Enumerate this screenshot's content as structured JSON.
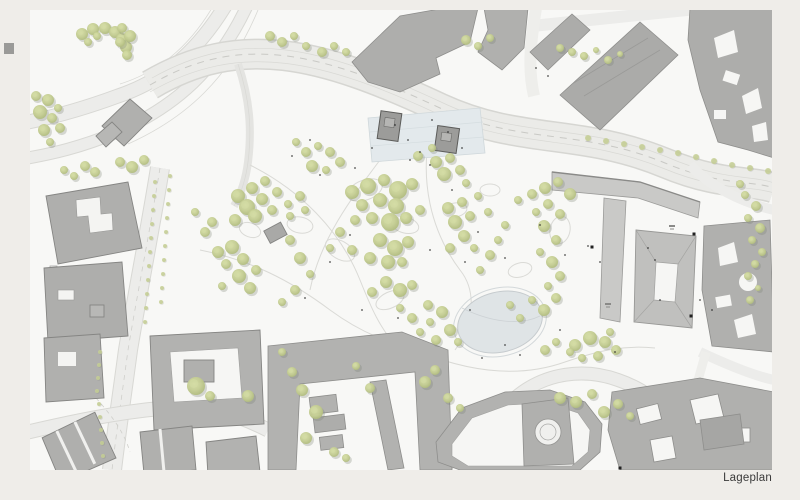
{
  "page": {
    "label": "Lageplan",
    "background": "#efede9",
    "sheet_color": "#f8f8f6"
  },
  "palette": {
    "road_fill": "#ebebe8",
    "road_edge": "#d6d6d2",
    "street_light": "#eeeeeb",
    "path_line": "#d9d9d5",
    "building": "#b2b2b0",
    "building_dark": "#a6a6a4",
    "building_light": "#c9c9c7",
    "building_court": "#c0c0be",
    "outline": "#8a8a87",
    "outline_soft": "#9b9b99",
    "plaza_fill": "#e3e9ec",
    "plaza_line": "#d5dde0",
    "pond_fill_a": "#e4e9eb",
    "pond_fill_b": "#d9dee1",
    "pond_edge": "#c6cbce",
    "tree_core": "#d4dca4",
    "tree_mid": "#c6cf94",
    "tree_edge": "#b2bd80",
    "tree_shadow": "#777d6e",
    "marker": "#222222"
  },
  "plan": {
    "sheet": {
      "x": 30,
      "y": 10,
      "w": 742,
      "h": 460
    },
    "pond": {
      "cx": 500,
      "cy": 322,
      "rx": 43,
      "ry": 30,
      "rotation": -14
    },
    "plaza": {
      "points": "368,118 480,108 485,153 372,162"
    }
  },
  "trees": {
    "park": [
      [
        238,
        196,
        7
      ],
      [
        252,
        188,
        6
      ],
      [
        265,
        181,
        5
      ],
      [
        247,
        207,
        8
      ],
      [
        262,
        199,
        6
      ],
      [
        277,
        192,
        5
      ],
      [
        235,
        220,
        6
      ],
      [
        255,
        216,
        7
      ],
      [
        272,
        210,
        5
      ],
      [
        288,
        204,
        4
      ],
      [
        300,
        196,
        5
      ],
      [
        290,
        216,
        4
      ],
      [
        305,
        210,
        4
      ],
      [
        205,
        232,
        5
      ],
      [
        195,
        212,
        4
      ],
      [
        212,
        222,
        5
      ],
      [
        218,
        252,
        6
      ],
      [
        232,
        247,
        7
      ],
      [
        226,
        264,
        5
      ],
      [
        243,
        259,
        6
      ],
      [
        239,
        276,
        7
      ],
      [
        256,
        270,
        5
      ],
      [
        222,
        286,
        4
      ],
      [
        250,
        288,
        6
      ],
      [
        290,
        240,
        5
      ],
      [
        300,
        258,
        6
      ],
      [
        310,
        274,
        4
      ],
      [
        295,
        290,
        5
      ],
      [
        282,
        302,
        4
      ],
      [
        352,
        192,
        7
      ],
      [
        368,
        186,
        8
      ],
      [
        384,
        180,
        6
      ],
      [
        398,
        190,
        9
      ],
      [
        412,
        184,
        6
      ],
      [
        362,
        205,
        6
      ],
      [
        380,
        200,
        7
      ],
      [
        396,
        206,
        8
      ],
      [
        355,
        220,
        5
      ],
      [
        372,
        218,
        6
      ],
      [
        390,
        222,
        9
      ],
      [
        406,
        218,
        6
      ],
      [
        380,
        240,
        7
      ],
      [
        395,
        248,
        8
      ],
      [
        408,
        242,
        6
      ],
      [
        370,
        258,
        6
      ],
      [
        388,
        262,
        7
      ],
      [
        352,
        250,
        5
      ],
      [
        402,
        262,
        5
      ],
      [
        386,
        282,
        6
      ],
      [
        400,
        290,
        7
      ],
      [
        372,
        292,
        5
      ],
      [
        412,
        285,
        5
      ],
      [
        420,
        210,
        5
      ],
      [
        340,
        232,
        5
      ],
      [
        330,
        248,
        4
      ],
      [
        448,
        208,
        6
      ],
      [
        462,
        202,
        5
      ],
      [
        455,
        222,
        7
      ],
      [
        470,
        216,
        5
      ],
      [
        464,
        236,
        6
      ],
      [
        450,
        248,
        5
      ],
      [
        474,
        248,
        4
      ],
      [
        480,
        270,
        4
      ],
      [
        490,
        255,
        5
      ],
      [
        498,
        240,
        4
      ],
      [
        505,
        225,
        4
      ],
      [
        488,
        212,
        4
      ],
      [
        478,
        196,
        4
      ],
      [
        436,
        162,
        6
      ],
      [
        450,
        158,
        5
      ],
      [
        444,
        174,
        7
      ],
      [
        460,
        170,
        5
      ],
      [
        466,
        183,
        4
      ],
      [
        432,
        148,
        4
      ],
      [
        418,
        156,
        5
      ],
      [
        518,
        200,
        4
      ],
      [
        532,
        194,
        5
      ],
      [
        545,
        188,
        6
      ],
      [
        558,
        182,
        5
      ],
      [
        570,
        194,
        6
      ],
      [
        548,
        204,
        5
      ],
      [
        536,
        212,
        4
      ],
      [
        560,
        214,
        5
      ],
      [
        544,
        226,
        6
      ],
      [
        556,
        240,
        5
      ],
      [
        540,
        252,
        4
      ],
      [
        552,
        262,
        6
      ],
      [
        560,
        276,
        5
      ],
      [
        548,
        286,
        4
      ],
      [
        556,
        298,
        5
      ],
      [
        544,
        310,
        6
      ],
      [
        532,
        300,
        4
      ],
      [
        428,
        305,
        5
      ],
      [
        442,
        312,
        6
      ],
      [
        430,
        322,
        4
      ],
      [
        450,
        330,
        6
      ],
      [
        436,
        340,
        5
      ],
      [
        458,
        342,
        4
      ],
      [
        412,
        318,
        5
      ],
      [
        400,
        308,
        4
      ],
      [
        420,
        332,
        4
      ],
      [
        520,
        318,
        4
      ],
      [
        510,
        305,
        4
      ],
      [
        306,
        152,
        5
      ],
      [
        318,
        146,
        4
      ],
      [
        330,
        152,
        5
      ],
      [
        312,
        166,
        6
      ],
      [
        326,
        170,
        4
      ],
      [
        340,
        162,
        5
      ],
      [
        296,
        142,
        4
      ],
      [
        82,
        34,
        6
      ],
      [
        93,
        29,
        6
      ],
      [
        105,
        28,
        6
      ],
      [
        115,
        32,
        6
      ],
      [
        122,
        39,
        6
      ],
      [
        126,
        47,
        6
      ],
      [
        127,
        55,
        5
      ],
      [
        88,
        42,
        4
      ],
      [
        97,
        36,
        4
      ],
      [
        48,
        100,
        6
      ],
      [
        40,
        112,
        7
      ],
      [
        52,
        118,
        5
      ],
      [
        44,
        130,
        6
      ],
      [
        58,
        108,
        4
      ],
      [
        36,
        96,
        5
      ],
      [
        60,
        128,
        5
      ],
      [
        50,
        142,
        4
      ],
      [
        122,
        28,
        5
      ],
      [
        130,
        36,
        6
      ],
      [
        120,
        42,
        5
      ],
      [
        85,
        166,
        5
      ],
      [
        95,
        172,
        5
      ],
      [
        120,
        162,
        5
      ],
      [
        132,
        167,
        6
      ],
      [
        144,
        160,
        5
      ],
      [
        64,
        170,
        4
      ],
      [
        74,
        176,
        4
      ],
      [
        270,
        36,
        5
      ],
      [
        282,
        42,
        5
      ],
      [
        294,
        36,
        4
      ],
      [
        306,
        46,
        4
      ],
      [
        322,
        52,
        5
      ],
      [
        334,
        46,
        4
      ],
      [
        346,
        52,
        4
      ],
      [
        466,
        40,
        5
      ],
      [
        478,
        46,
        4
      ],
      [
        490,
        38,
        4
      ],
      [
        560,
        48,
        4
      ],
      [
        572,
        52,
        4
      ],
      [
        584,
        56,
        4
      ],
      [
        596,
        50,
        3
      ],
      [
        608,
        60,
        4
      ],
      [
        620,
        54,
        3
      ],
      [
        575,
        345,
        6
      ],
      [
        590,
        338,
        7
      ],
      [
        605,
        342,
        6
      ],
      [
        616,
        350,
        5
      ],
      [
        598,
        356,
        5
      ],
      [
        582,
        358,
        4
      ],
      [
        570,
        352,
        4
      ],
      [
        610,
        332,
        4
      ],
      [
        545,
        350,
        5
      ],
      [
        556,
        342,
        4
      ],
      [
        302,
        390,
        6
      ],
      [
        316,
        412,
        7
      ],
      [
        306,
        438,
        6
      ],
      [
        334,
        452,
        5
      ],
      [
        346,
        458,
        4
      ],
      [
        292,
        372,
        5
      ],
      [
        370,
        388,
        5
      ],
      [
        425,
        382,
        6
      ],
      [
        435,
        370,
        5
      ],
      [
        448,
        398,
        5
      ],
      [
        460,
        408,
        4
      ],
      [
        356,
        366,
        4
      ],
      [
        282,
        352,
        4
      ],
      [
        560,
        398,
        6
      ],
      [
        576,
        402,
        6
      ],
      [
        592,
        394,
        5
      ],
      [
        604,
        412,
        6
      ],
      [
        618,
        404,
        5
      ],
      [
        630,
        416,
        4
      ],
      [
        745,
        195,
        4
      ],
      [
        756,
        206,
        5
      ],
      [
        748,
        218,
        4
      ],
      [
        760,
        228,
        5
      ],
      [
        752,
        240,
        4
      ],
      [
        762,
        252,
        4
      ],
      [
        755,
        264,
        4
      ],
      [
        748,
        276,
        4
      ],
      [
        758,
        288,
        3
      ],
      [
        750,
        300,
        4
      ],
      [
        740,
        184,
        4
      ],
      [
        196,
        386,
        9
      ],
      [
        248,
        396,
        6
      ],
      [
        210,
        396,
        5
      ]
    ],
    "road_row": [
      [
        588,
        138,
        3
      ],
      [
        606,
        141,
        3
      ],
      [
        624,
        144,
        3
      ],
      [
        642,
        147,
        3
      ],
      [
        660,
        150,
        3
      ],
      [
        678,
        153,
        3
      ],
      [
        696,
        157,
        3
      ],
      [
        714,
        161,
        3
      ],
      [
        732,
        165,
        3
      ],
      [
        750,
        168,
        3
      ],
      [
        768,
        171,
        3
      ]
    ],
    "street_small": [
      [
        100,
        352,
        2
      ],
      [
        99,
        365,
        2
      ],
      [
        98,
        378,
        2
      ],
      [
        97,
        391,
        2
      ],
      [
        99,
        404,
        2
      ],
      [
        100,
        417,
        2
      ],
      [
        101,
        430,
        2
      ],
      [
        102,
        443,
        2
      ],
      [
        103,
        456,
        2
      ],
      [
        155,
        182,
        2
      ],
      [
        154,
        196,
        2
      ],
      [
        153,
        210,
        2
      ],
      [
        152,
        224,
        2
      ],
      [
        151,
        238,
        2
      ],
      [
        150,
        252,
        2
      ],
      [
        149,
        266,
        2
      ],
      [
        148,
        280,
        2
      ],
      [
        147,
        294,
        2
      ],
      [
        146,
        308,
        2
      ],
      [
        145,
        322,
        2
      ],
      [
        170,
        176,
        2
      ],
      [
        169,
        190,
        2
      ],
      [
        168,
        204,
        2
      ],
      [
        167,
        218,
        2
      ],
      [
        166,
        232,
        2
      ],
      [
        165,
        246,
        2
      ],
      [
        164,
        260,
        2
      ],
      [
        163,
        274,
        2
      ],
      [
        162,
        288,
        2
      ],
      [
        161,
        302,
        2
      ]
    ],
    "dots": [
      [
        320,
        175
      ],
      [
        355,
        168
      ],
      [
        410,
        160
      ],
      [
        452,
        190
      ],
      [
        478,
        232
      ],
      [
        505,
        258
      ],
      [
        465,
        262
      ],
      [
        430,
        250
      ],
      [
        350,
        235
      ],
      [
        330,
        262
      ],
      [
        305,
        298
      ],
      [
        362,
        310
      ],
      [
        398,
        318
      ],
      [
        470,
        310
      ],
      [
        540,
        225
      ],
      [
        565,
        255
      ],
      [
        588,
        246
      ],
      [
        600,
        262
      ],
      [
        615,
        352
      ],
      [
        520,
        355
      ],
      [
        432,
        120
      ],
      [
        448,
        132
      ],
      [
        462,
        148
      ],
      [
        310,
        140
      ],
      [
        292,
        156
      ],
      [
        395,
        125
      ],
      [
        408,
        140
      ],
      [
        420,
        152
      ],
      [
        372,
        148
      ],
      [
        430,
        165
      ],
      [
        560,
        330
      ],
      [
        505,
        345
      ],
      [
        482,
        358
      ],
      [
        536,
        68
      ],
      [
        548,
        76
      ],
      [
        660,
        300
      ],
      [
        700,
        300
      ],
      [
        712,
        310
      ],
      [
        655,
        260
      ],
      [
        648,
        248
      ]
    ],
    "entrances": [
      [
        694,
        234
      ],
      [
        691,
        316
      ],
      [
        592,
        247
      ],
      [
        620,
        468
      ]
    ]
  }
}
